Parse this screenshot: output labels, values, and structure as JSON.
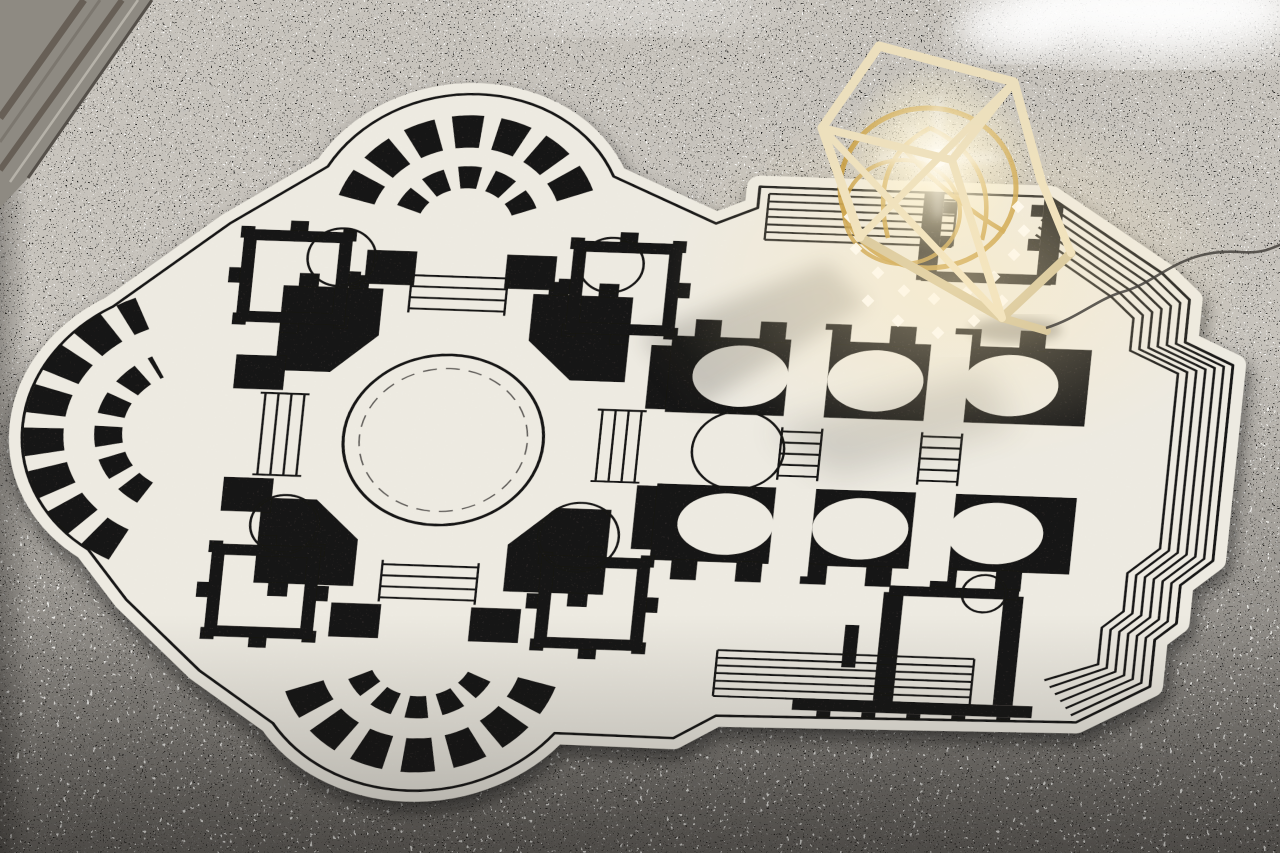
{
  "scene": {
    "type": "photograph",
    "description": "Cream rug shaped and printed as a black baroque basilica floor plan, lying on a grey terrazzo floor; a wooden polyhedral cage lamp with a gold crystal chandelier glows on the rug's upper-right corner",
    "floor": {
      "material": "terrazzo",
      "base_color": "#c7c3bc",
      "speckle_dark_color": "#22201d",
      "speckle_light_color": "#f5f3ef",
      "blotch_color": "#8f8b84",
      "inlay_color": "#8e8a82",
      "inlay_stripe_dark": "#675f56",
      "inlay_stripe_light": "#b6b2a9",
      "shadow_color": "#161412"
    },
    "rug": {
      "motif": "basilica floor plan with lobed apses, colonnades, domed crossing and stepped facade border",
      "field_color": "#edeae1",
      "plan_color": "#171412"
    },
    "lamp": {
      "style": "wooden polyhedron frame containing a crystal chandelier",
      "frame_color": "#ecdfbd",
      "frame_shade_color": "#cdbd92",
      "chandelier_color": "#c0922f",
      "crystal_color": "#ffffff",
      "glow_color": "#fff3d2",
      "cord_color": "#45423d"
    },
    "lighting": {
      "window_reflection_color": "#ffffff"
    }
  }
}
